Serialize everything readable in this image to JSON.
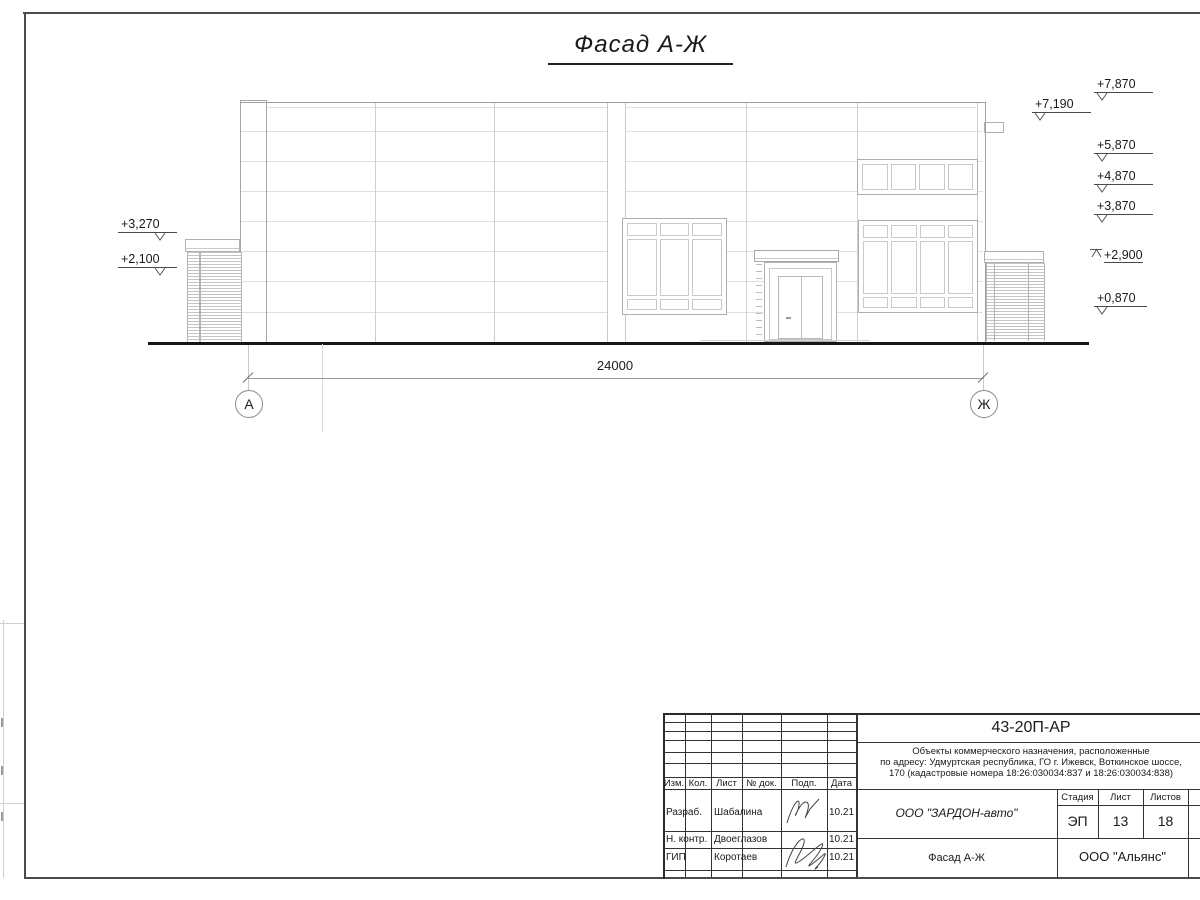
{
  "colors": {
    "ink": "#1a1a1a",
    "line_light": "#dfdfdf",
    "line_mid": "#c4c4c4",
    "line_dark": "#9a9a9a",
    "ground": "#161616"
  },
  "drawing": {
    "title": "Фасад А-Ж",
    "dimension_total": "24000",
    "axis_left": "А",
    "axis_right": "Ж",
    "elevations_right": [
      "+7,870",
      "+7,190",
      "+5,870",
      "+4,870",
      "+3,870",
      "+2,900",
      "+0,870"
    ],
    "elevations_left": [
      "+3,270",
      "+2,100"
    ]
  },
  "title_block": {
    "doc_number": "43-20П-АР",
    "description": [
      "Объекты коммерческого назначения, расположенные",
      "по адресу: Удмуртская республика, ГО г. Ижевск, Воткинское шоссе,",
      "170 (кадастровые номера 18:26:030034:837 и 18:26:030034:838)"
    ],
    "header_cols": {
      "izm": "Изм.",
      "kol": "Кол.",
      "list": "Лист",
      "ndok": "№ док.",
      "podp": "Подп.",
      "data": "Дата"
    },
    "signature_rows": [
      {
        "role": "Разраб.",
        "name": "Шабалина",
        "date": "10.21"
      },
      {
        "role": "Н. контр.",
        "name": "Двоеглазов",
        "date": "10.21"
      },
      {
        "role": "ГИП",
        "name": "Коротаев",
        "date": "10.21"
      }
    ],
    "stage_label": "Стадия",
    "list_label": "Лист",
    "listov_label": "Листов",
    "stage_value": "ЭП",
    "list_value": "13",
    "listov_value": "18",
    "company": "ООО \"ЗАРДОН-авто\"",
    "drawing_name": "Фасад А-Ж",
    "org": "ООО \"Альянс\""
  }
}
